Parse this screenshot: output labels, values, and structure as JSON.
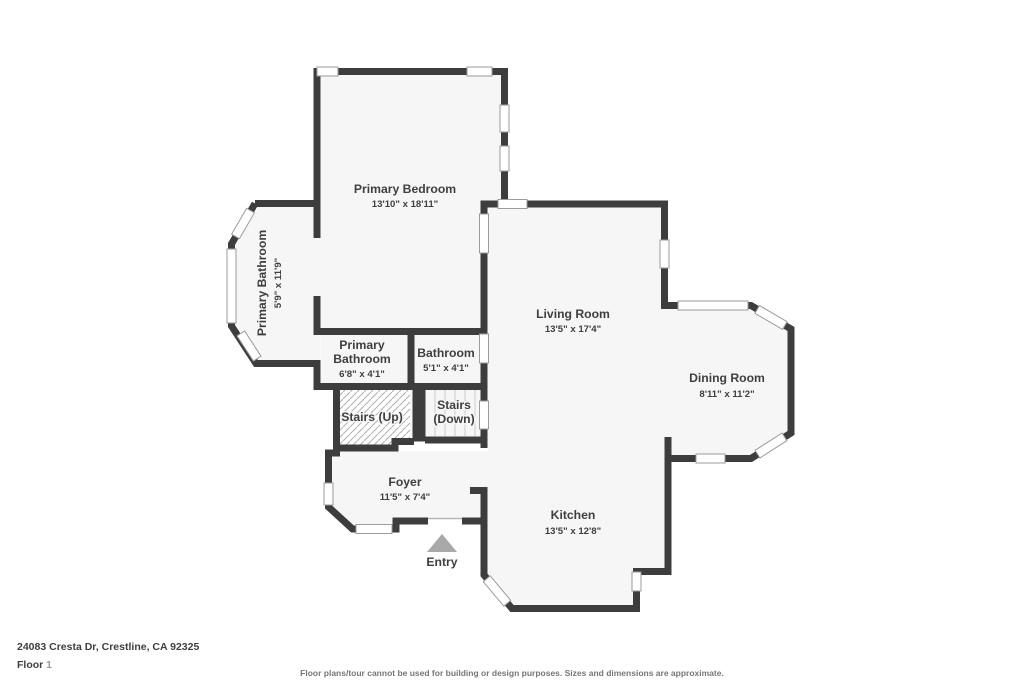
{
  "rooms": {
    "primary_bedroom": {
      "name": "Primary Bedroom",
      "dims": "13'10\" x 18'11\""
    },
    "primary_bathroom_bay": {
      "name": "Primary Bathroom",
      "dims": "5'9\" x 11'9\""
    },
    "primary_bathroom": {
      "line1": "Primary",
      "line2": "Bathroom",
      "dims": "6'8\" x 4'1\""
    },
    "bathroom": {
      "name": "Bathroom",
      "dims": "5'1\" x 4'1\""
    },
    "stairs_up": {
      "name": "Stairs (Up)"
    },
    "stairs_down": {
      "line1": "Stairs",
      "line2": "(Down)"
    },
    "foyer": {
      "name": "Foyer",
      "dims": "11'5\" x 7'4\""
    },
    "entry": {
      "name": "Entry"
    },
    "living_room": {
      "name": "Living Room",
      "dims": "13'5\" x 17'4\""
    },
    "dining_room": {
      "name": "Dining Room",
      "dims": "8'11\" x 11'2\""
    },
    "kitchen": {
      "name": "Kitchen",
      "dims": "13'5\" x 12'8\""
    }
  },
  "footer": {
    "address": "24083 Cresta Dr, Crestline, CA 92325",
    "floor_label": "Floor",
    "floor_number": "1",
    "disclaimer": "Floor plans/tour cannot be used for building or design purposes. Sizes and dimensions are approximate."
  },
  "colors": {
    "wall": "#3d3d3d",
    "room_fill": "#f6f6f6",
    "window_border": "#9b9b9b",
    "entry_marker": "#a8a8a8"
  }
}
